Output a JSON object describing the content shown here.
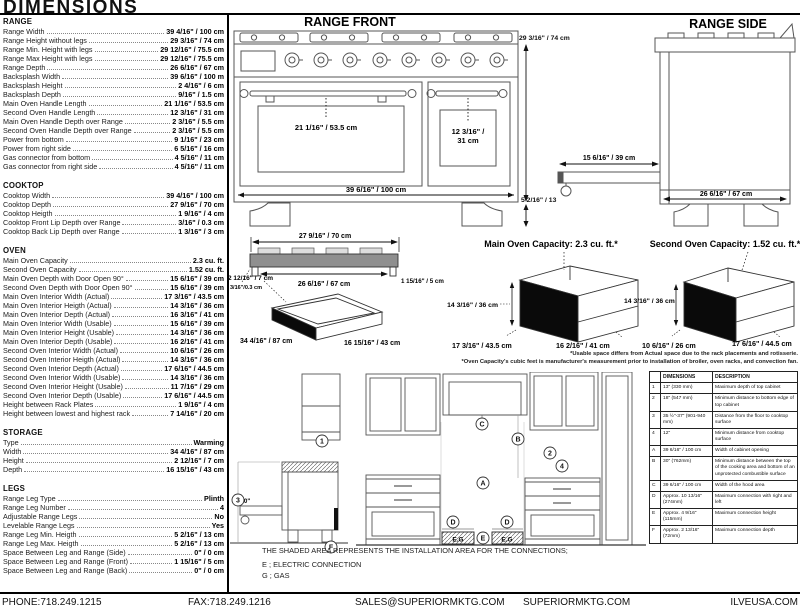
{
  "title": "DIMENSIONS",
  "specs": {
    "sections": [
      {
        "name": "RANGE",
        "rows": [
          {
            "label": "Range Width",
            "value": "39 4/16\" / 100 cm"
          },
          {
            "label": "Range Height without legs",
            "value": "29 3/16\" / 74 cm"
          },
          {
            "label": "Range Min. Height with legs",
            "value": "29 12/16\" / 75.5 cm"
          },
          {
            "label": "Range Max Height with legs",
            "value": "29 12/16\" / 75.5 cm"
          },
          {
            "label": "Range Depth",
            "value": "26 6/16\" / 67 cm"
          },
          {
            "label": "Backsplash Width",
            "value": "39 6/16\" / 100 m"
          },
          {
            "label": "Backsplash Height",
            "value": "2 4/16\" / 6 cm"
          },
          {
            "label": "Backsplash Depth",
            "value": "9/16\" / 1.5 cm"
          },
          {
            "label": "Main Oven Handle Length",
            "value": "21 1/16\" / 53.5 cm"
          },
          {
            "label": "Second Oven Handle Length",
            "value": "12 3/16\" / 31 cm"
          },
          {
            "label": "Main Oven Handle Depth over Range",
            "value": "2 3/16\" / 5.5 cm"
          },
          {
            "label": "Second Oven Handle Depth over Range",
            "value": "2 3/16\" / 5.5 cm"
          },
          {
            "label": "Power from bottom",
            "value": "9 1/16\" / 23 cm"
          },
          {
            "label": "Power from right side",
            "value": "6 5/16\" / 16 cm"
          },
          {
            "label": "Gas connector from bottom",
            "value": "4 5/16\" / 11 cm"
          },
          {
            "label": "Gas connector from right side",
            "value": "4 5/16\" / 11 cm"
          }
        ]
      },
      {
        "name": "COOKTOP",
        "rows": [
          {
            "label": "Cooktop Width",
            "value": "39 4/16\" / 100 cm"
          },
          {
            "label": "Cooktop Depth",
            "value": "27 9/16\" / 70 cm"
          },
          {
            "label": "Cooktop Heigth",
            "value": "1 9/16\" / 4 cm"
          },
          {
            "label": "Cooktop Front Lip Depth over Range",
            "value": "3/16\" / 0.3 cm"
          },
          {
            "label": "Cooktop Back Lip Depth over Range",
            "value": "1 3/16\" / 3 cm"
          }
        ]
      },
      {
        "name": "OVEN",
        "rows": [
          {
            "label": "Main Oven Capacity",
            "value": "2.3 cu. ft."
          },
          {
            "label": "Second Oven Capacity",
            "value": "1.52 cu. ft."
          },
          {
            "label": "Main Oven Depth with Door Open 90°",
            "value": "15 6/16\" / 39 cm"
          },
          {
            "label": "Second Oven Depth with Door Open 90°",
            "value": "15 6/16\" / 39 cm"
          },
          {
            "label": "Main Oven Interior Width (Actual)",
            "value": "17 3/16\" / 43.5 cm"
          },
          {
            "label": "Main Oven Interior Heigth (Actual)",
            "value": "14 3/16\" / 36 cm"
          },
          {
            "label": "Main Oven Interior Depth (Actual)",
            "value": "16 3/16\" / 41 cm"
          },
          {
            "label": "Main Oven Interior Width (Usable)",
            "value": "15 6/16\" / 39 cm"
          },
          {
            "label": "Main Oven Interior Height (Usable)",
            "value": "14 3/16\" / 36 cm"
          },
          {
            "label": "Main Oven Interior Depth (Usable)",
            "value": "16 2/16\" / 41 cm"
          },
          {
            "label": "Second Oven Interior Width (Actual)",
            "value": "10 6/16\" / 26 cm"
          },
          {
            "label": "Second Oven Interior Heigth (Actual)",
            "value": "14 3/16\" / 36 cm"
          },
          {
            "label": "Second Oven Interior Depth (Actual)",
            "value": "17 6/16\" / 44.5 cm"
          },
          {
            "label": "Second Oven Interior Width (Usable)",
            "value": "14 3/16\" / 36 cm"
          },
          {
            "label": "Second Oven Interior Height (Usable)",
            "value": "11 7/16\" / 29 cm"
          },
          {
            "label": "Second Oven Interior Depth (Usable)",
            "value": "17 6/16\" / 44.5 cm"
          },
          {
            "label": "Height between Rack Plates",
            "value": "1 9/16\" / 4 cm"
          },
          {
            "label": "Height between lowest and highest rack",
            "value": "7 14/16\" / 20 cm"
          }
        ]
      },
      {
        "name": "STORAGE",
        "rows": [
          {
            "label": "Type",
            "value": "Warming"
          },
          {
            "label": "Width",
            "value": "34 4/16\" / 87 cm"
          },
          {
            "label": "Height",
            "value": "2 12/16\" / 7 cm"
          },
          {
            "label": "Depth",
            "value": "16 15/16\" / 43 cm"
          }
        ]
      },
      {
        "name": "LEGS",
        "rows": [
          {
            "label": "Range Leg Type",
            "value": "Plinth"
          },
          {
            "label": "Range Leg Number",
            "value": "4"
          },
          {
            "label": "Adjustable Range Legs",
            "value": "No"
          },
          {
            "label": "Levelable Range Legs",
            "value": "Yes"
          },
          {
            "label": "Range Leg Min. Heigth",
            "value": "5 2/16\" / 13 cm"
          },
          {
            "label": "Range Leg Max. Heigth",
            "value": "5 2/16\" / 13 cm"
          },
          {
            "label": "Space Between Leg and Range (Side)",
            "value": "0\" / 0 cm"
          },
          {
            "label": "Space Between Leg and Range (Front)",
            "value": "1 15/16\" / 5 cm"
          },
          {
            "label": "Space Between Leg and Range (Back)",
            "value": "0\" / 0 cm"
          }
        ]
      }
    ]
  },
  "drawings": {
    "range_front": {
      "title": "RANGE FRONT",
      "main_handle_label": "21 1/16\" / 53.5 cm",
      "second_handle_line1": "12 3/16\" /",
      "second_handle_line2": "31 cm",
      "width_label": "39 6/16\" / 100 cm",
      "height_label": "29 3/16\" / 74 cm",
      "legs_label": "5 2/16\" / 13"
    },
    "range_side": {
      "title": "RANGE SIDE",
      "door_label": "15 6/16\" / 39 cm",
      "depth_label": "26 6/16\" / 67 cm"
    },
    "cooktop": {
      "width_label": "27 9/16\" / 70 cm",
      "inner_label": "26 6/16\" / 67 cm",
      "front_lip_label": "3/16\"/0.3 cm",
      "back_lip_label": "1 15/16\" / 5 cm"
    },
    "storage": {
      "height_label": "2 12/16\" / 7 cm",
      "width_label": "34 4/16\" / 87 cm",
      "depth_label": "16 15/16\" / 43 cm"
    },
    "main_oven": {
      "title": "Main Oven Capacity: 2.3 cu. ft.*",
      "height_label": "14 3/16\" / 36 cm",
      "width_label": "17 3/16\" / 43.5 cm",
      "depth_label": "16 2/16\" / 41 cm"
    },
    "second_oven": {
      "title": "Second Oven Capacity: 1.52 cu. ft.*",
      "height_label": "14 3/16\" / 36 cm",
      "width_label": "10 6/16\" / 26 cm",
      "depth_label": "17 6/16\" / 44.5 cm"
    },
    "footnote_1": "*Usable space differs from Actual space due to the rack placements and rotisserie.",
    "footnote_2": "*Oven Capacity's cubic feet is manufacturer's measurement prior to installation of broiler, oven racks, and convection fan."
  },
  "installation": {
    "markers": {
      "k1": "1",
      "k2": "2",
      "k3": "3",
      "k4": "4",
      "kA": "A",
      "kB": "B",
      "kC": "C",
      "kD": "D",
      "kE": "E",
      "kF": "F"
    },
    "zero_label": "0\"",
    "eg_label": "E.G",
    "note": "THE SHADED AREA REPRESENTS THE INSTALLATION AREA FOR THE CONNECTIONS;",
    "legend_e": "E ; ELECTRIC CONNECTION",
    "legend_g": "G ; GAS"
  },
  "reference_table": {
    "headers": [
      "",
      "DIMENSIONS",
      "DESCRIPTION"
    ],
    "rows": [
      {
        "ref": "1",
        "dim": "13\" (330 mm)",
        "desc": "Maximum depth of top cabinet"
      },
      {
        "ref": "2",
        "dim": "18\" (547 mm)",
        "desc": "Minimum distance to bottom edge of top cabinet"
      },
      {
        "ref": "3",
        "dim": "35 ½\"-37\" (901-940 mm)",
        "desc": "Distance from the floor to cooktop surface"
      },
      {
        "ref": "4",
        "dim": "12\"",
        "desc": "Minimum distance from cooktop surface"
      },
      {
        "ref": "A",
        "dim": "39 6/16\" / 100 cm",
        "desc": "Width of cabinet opening"
      },
      {
        "ref": "B",
        "dim": "30\" (762mm)",
        "desc": "Minimum distance between the top of the cooking area and bottom of an unprotected combustible surface"
      },
      {
        "ref": "C",
        "dim": "39 6/16\" / 100 cm",
        "desc": "Width of the hood area"
      },
      {
        "ref": "D",
        "dim": "Approx. 10 13/16\" (274mm)",
        "desc": "Maximum connection with right and left"
      },
      {
        "ref": "E",
        "dim": "Approx. 4 9/16\" (115mm)",
        "desc": "Maximum connection height"
      },
      {
        "ref": "F",
        "dim": "Approx. 2 13/16\" (72mm)",
        "desc": "Maximum connection depth"
      }
    ]
  },
  "footer": {
    "phone": "PHONE:718.249.1215",
    "fax": "FAX:718.249.1216",
    "email": "SALES@SUPERIORMKTG.COM",
    "website": "SUPERIORMKTG.COM",
    "brand_site": "ILVEUSA.COM"
  }
}
